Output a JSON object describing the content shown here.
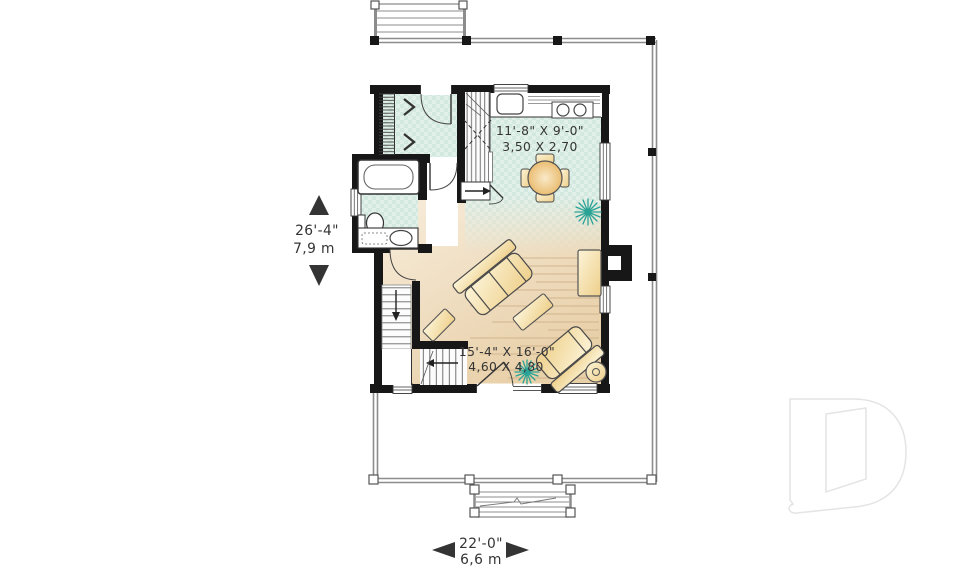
{
  "floor_plan": {
    "rooms": {
      "kitchen": {
        "dim_imperial": "11'-8\" X 9'-0\"",
        "dim_metric": "3,50 X 2,70"
      },
      "living": {
        "dim_imperial": "15'-4\" X 16'-0\"",
        "dim_metric": "4,60 X 4,80"
      }
    },
    "overall": {
      "depth_imperial": "26'-4\"",
      "depth_metric": "7,9 m",
      "width_imperial": "22'-0\"",
      "width_metric": "6,6 m"
    },
    "colors": {
      "wall": "#171717",
      "tile": "#deeee8",
      "wood": "#ecd6b2",
      "furniture": "#f3dd9e",
      "plant": "#2aa396",
      "deck": "#8c8c8c",
      "logo_outline": "#e4e4e4",
      "text": "#343434"
    }
  }
}
